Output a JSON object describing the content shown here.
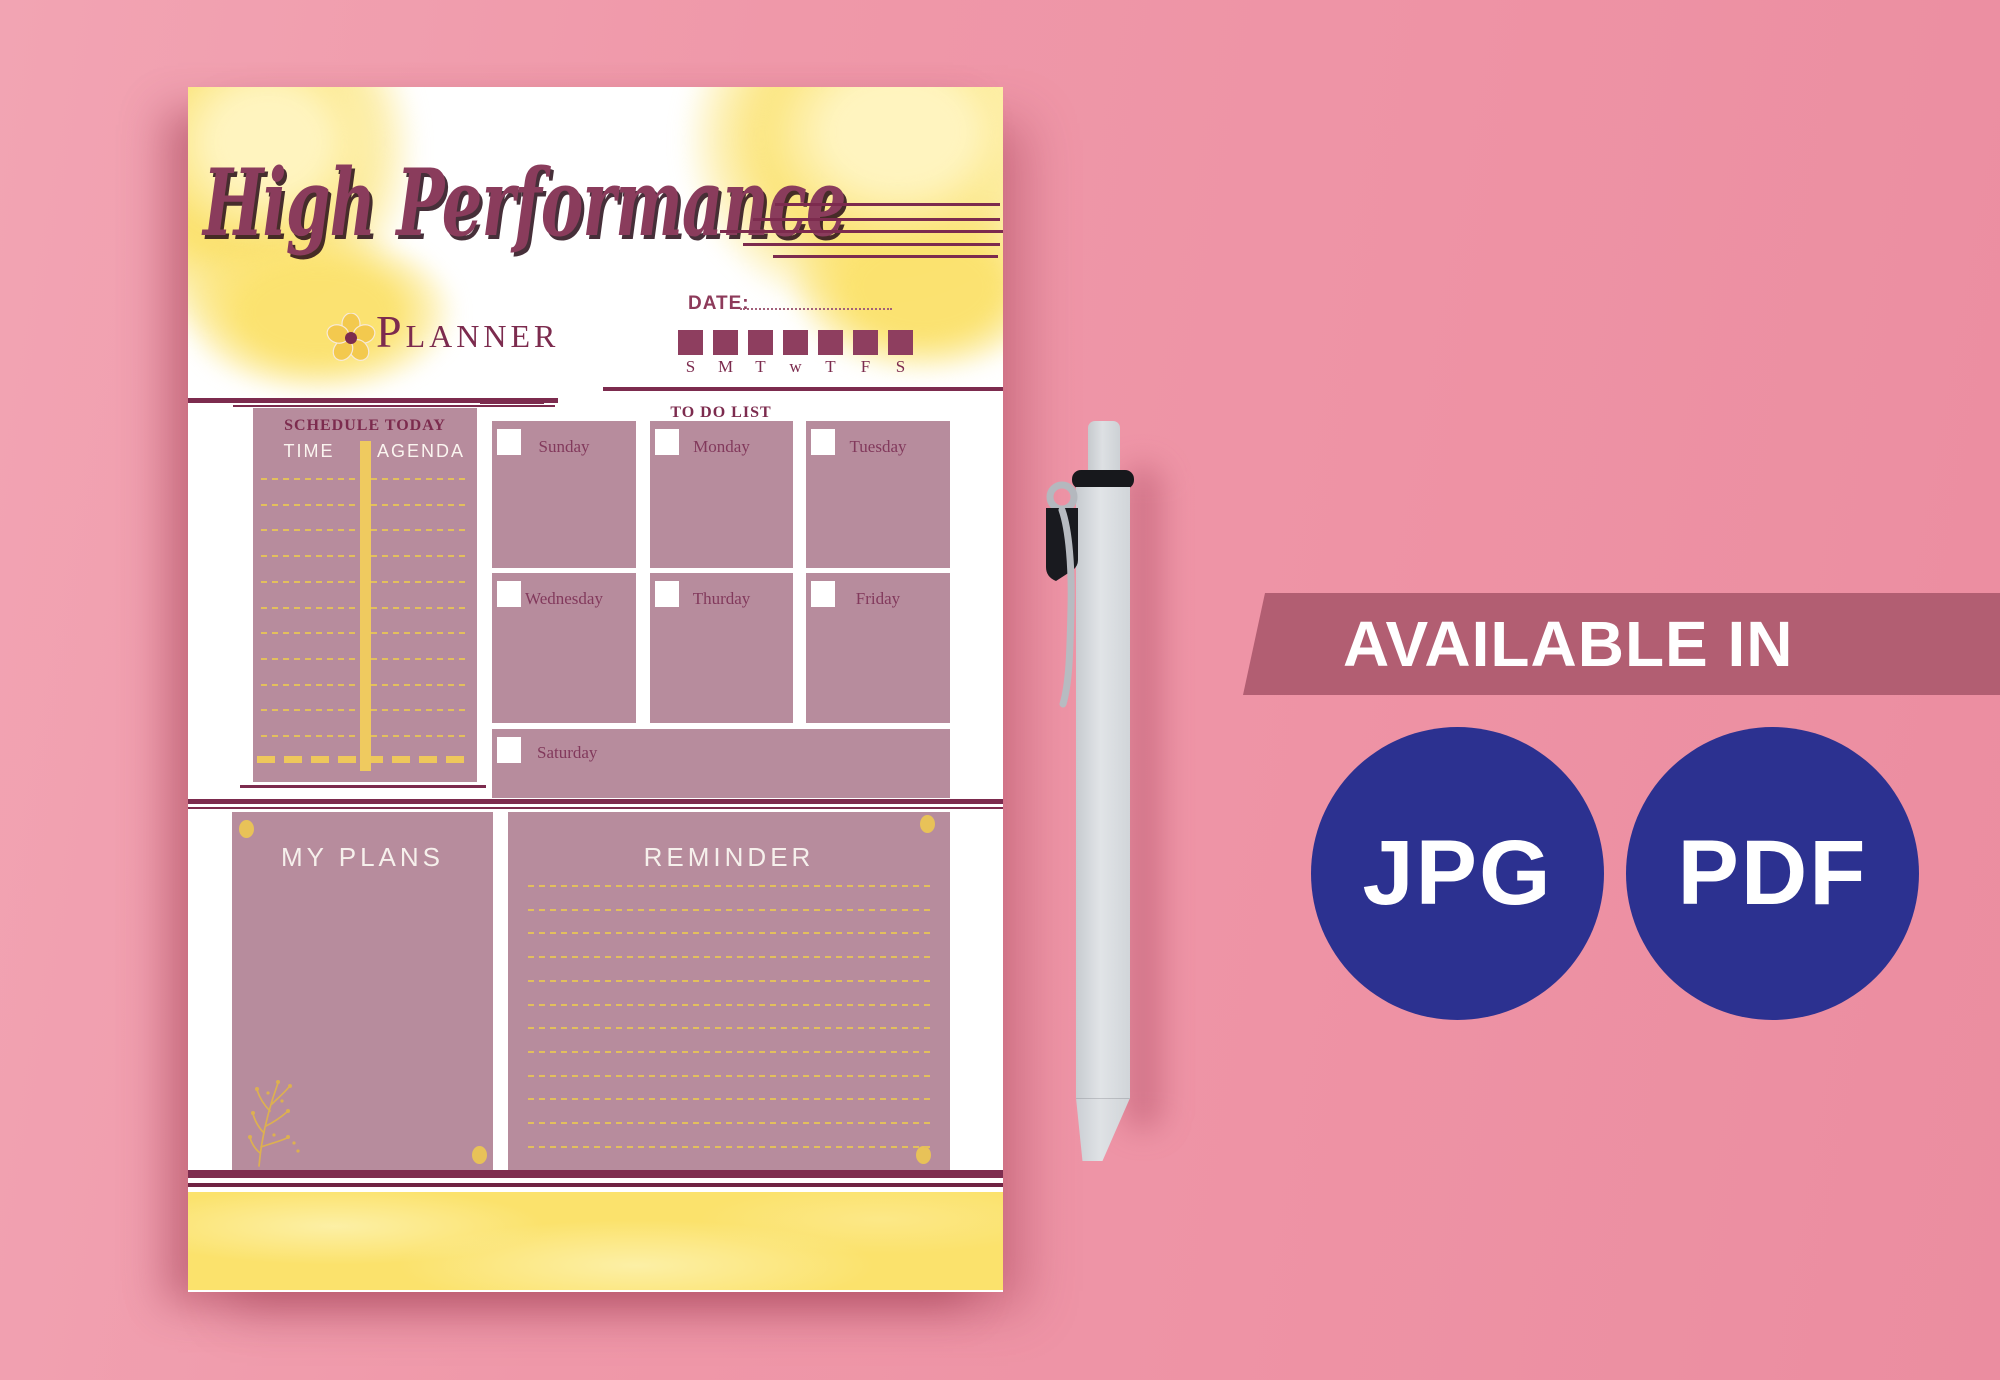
{
  "planner": {
    "title_line1": "High Performance",
    "title_line2": "Planner",
    "date_label": "DATE:",
    "week_letters": [
      "S",
      "M",
      "T",
      "w",
      "T",
      "F",
      "S"
    ],
    "schedule": {
      "title": "SCHEDULE TODAY",
      "time_header": "TIME",
      "agenda_header": "AGENDA"
    },
    "todo": {
      "title": "TO DO LIST",
      "days": [
        "Sunday",
        "Monday",
        "Tuesday",
        "Wednesday",
        "Thurday",
        "Friday",
        "Saturday"
      ]
    },
    "plans": {
      "title": "MY PLANS"
    },
    "reminder": {
      "title": "REMINDER"
    }
  },
  "promo": {
    "banner": "AVAILABLE IN",
    "formats": [
      "JPG",
      "PDF"
    ]
  },
  "colors": {
    "maroon": "#7c2b4e",
    "mauve": "#b78c9d",
    "yellow": "#fbe26c",
    "gold": "#e8c258",
    "banner_rose": "#b25e72",
    "navy": "#2c3190",
    "pink_background": "#ef97a9",
    "paper": "#ffffff"
  }
}
